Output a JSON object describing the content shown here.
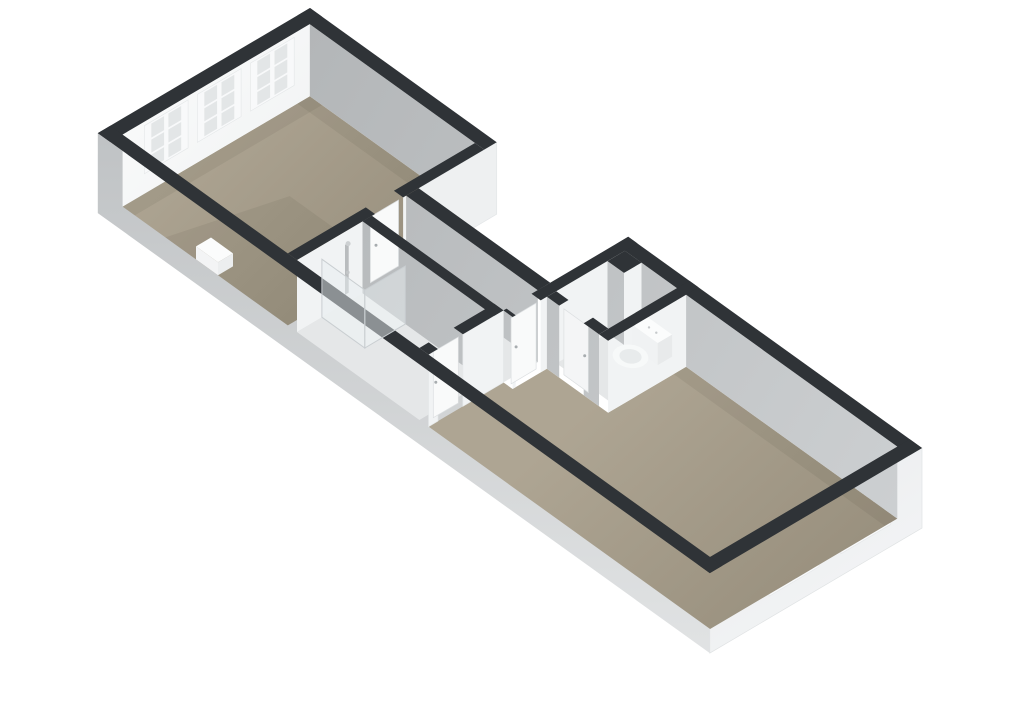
{
  "scene": {
    "label": "3D isometric floor plan",
    "rooms": [
      {
        "id": "living-room",
        "floor": "taupe"
      },
      {
        "id": "hall",
        "floor": "light"
      },
      {
        "id": "bathroom",
        "floor": "light"
      },
      {
        "id": "wc",
        "floor": "light"
      },
      {
        "id": "bedroom",
        "floor": "taupe"
      }
    ],
    "windows": {
      "front_facade": 3,
      "rear_facade": 2
    },
    "doors": [
      "living-room-door",
      "bedroom-door",
      "wc-door",
      "bathroom-door"
    ],
    "fixtures": [
      "toilet",
      "shower",
      "radiator",
      "duct"
    ]
  },
  "colors": {
    "background": "#ffffff",
    "wall_top": "#2f3337",
    "floor_taupe_light": "#aea593",
    "floor_taupe_dark": "#948b79",
    "floor_light": "#e5e7e8",
    "shower_tray": "#eff1f1",
    "wall_gray_dark": "#b2b5b7",
    "wall_gray_light": "#cdd0d2",
    "wall_white": "#f1f3f4",
    "wall_white_bright": "#fafbfb",
    "wall_white_dim": "#eef0f1",
    "ext_gray_top": "#c0c3c5",
    "ext_gray_bottom": "#e1e3e4",
    "end_white_dim": "#eaecee",
    "end_white_bright": "#f4f5f6",
    "window_frame": "#f8f9fa",
    "window_pane_inner": "#e3e6e7",
    "window_pane_outer": "#c6c9cb",
    "door": "#f9fafa",
    "handle": "#a7acaf",
    "cistern_button": "#c6c9cb",
    "toilet_white": "#f7f9f9",
    "toilet_inner": "#e8ebec",
    "fixture_metal": "#b9bcbe",
    "glass": "rgba(232,238,240,0.5)",
    "glass_edge": "#c9ced1",
    "shadow": "rgba(40,36,25,0.07)"
  }
}
